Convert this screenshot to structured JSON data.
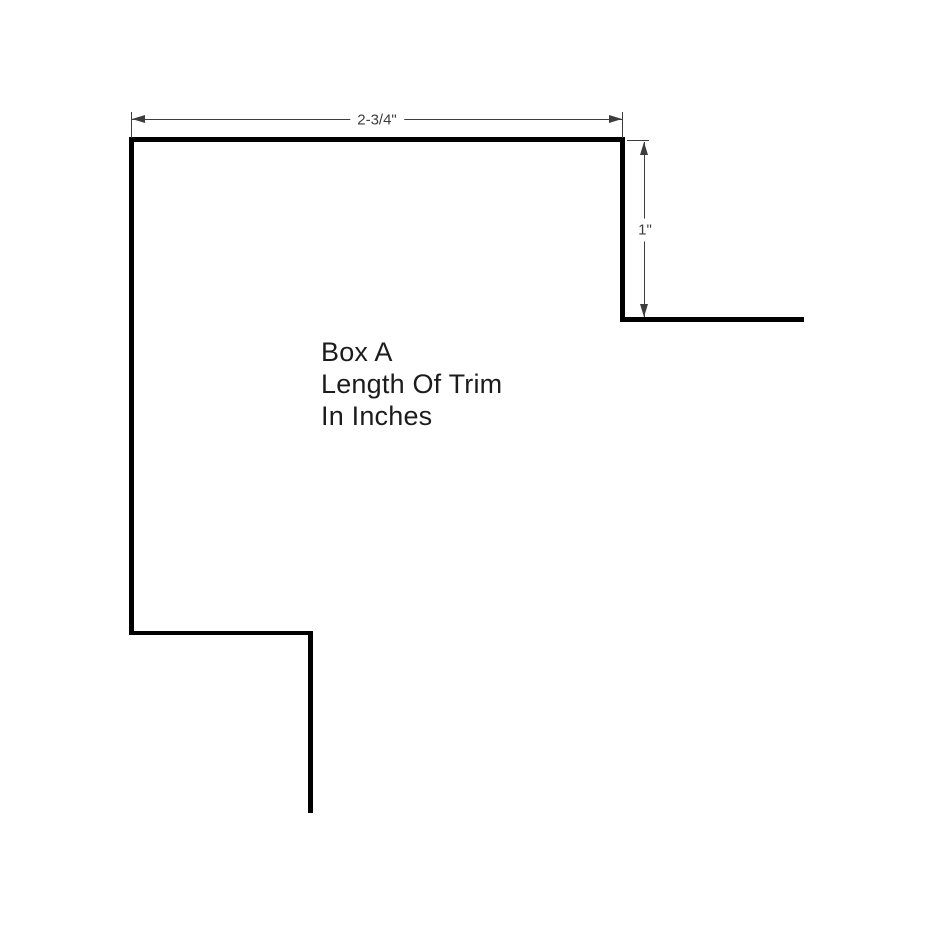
{
  "drawing": {
    "note": {
      "line1": "Box A",
      "line2": "Length Of Trim",
      "line3": "In Inches"
    },
    "dimensions": {
      "width": {
        "label": "2-3/4\""
      },
      "depth": {
        "label": "1\""
      }
    },
    "colors": {
      "outline": "#000000",
      "dimension": "#3d3d3d",
      "note_text": "#1c1c1c",
      "background": "#ffffff"
    }
  }
}
